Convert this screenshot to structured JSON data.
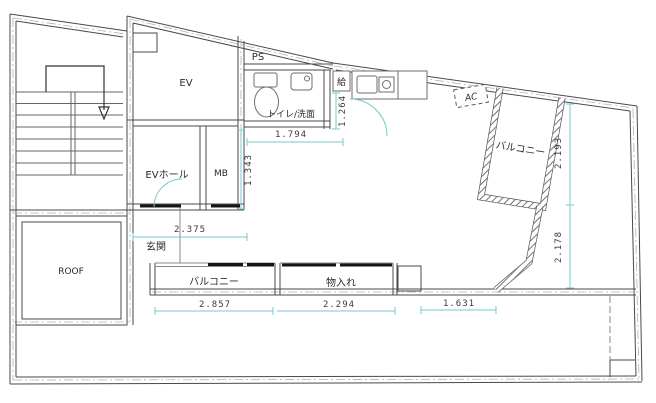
{
  "plan": {
    "title": "floor-plan",
    "labels": {
      "ev": "EV",
      "ps": "PS",
      "toilet": "トイレ/洗面",
      "supply": "給",
      "ev_hall": "EVホール",
      "mb": "MB",
      "roof": "ROOF",
      "entrance": "玄関",
      "balcony_right": "バルコニー",
      "balcony_bottom": "バルコニー",
      "storage": "物入れ",
      "ac": "AC"
    },
    "dimensions": {
      "toilet_width": "1.794",
      "hall_height": "1.343",
      "kitchen_height": "1.264",
      "entrance_width": "2.375",
      "balcony_width": "2.857",
      "storage_width": "2.294",
      "opening_width": "1.631",
      "balcony_right_height": "2.193",
      "room_height": "2.178"
    },
    "colors": {
      "dimension_line": "#76c9cb",
      "wall_line": "#4a4a4a",
      "threshold": "#151515"
    }
  }
}
